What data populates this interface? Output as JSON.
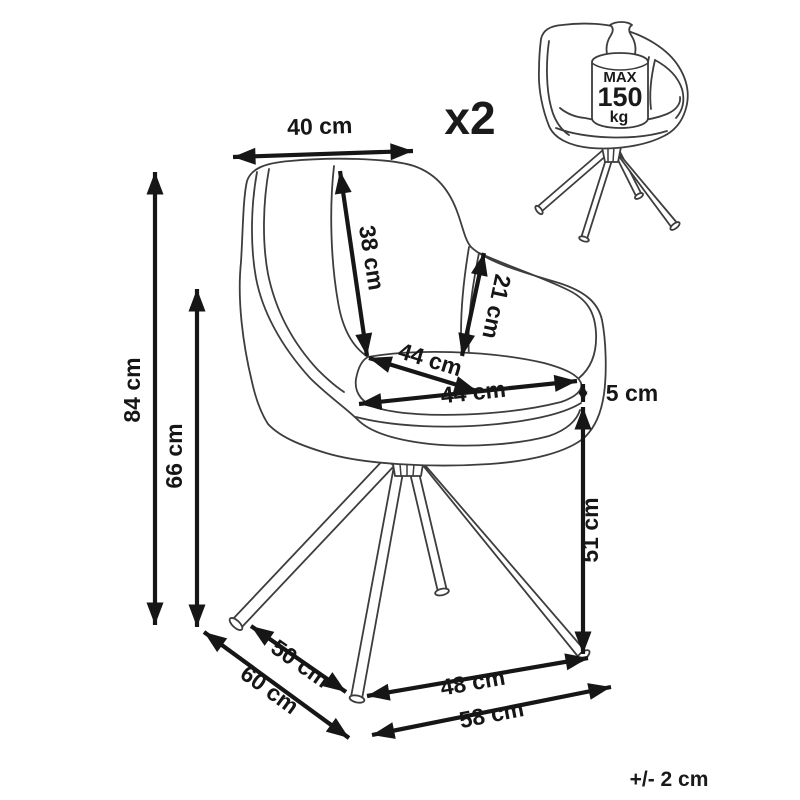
{
  "diagram": {
    "quantity": "x2",
    "weight_limit": {
      "line1": "MAX",
      "line2": "150",
      "line3": "kg"
    },
    "tolerance": "+/- 2 cm",
    "dimensions": {
      "top_width": "40 cm",
      "total_height": "84 cm",
      "armrest_floor_height": "66 cm",
      "backrest_height": "38 cm",
      "armrest_height": "21 cm",
      "seat_depth": "44 cm",
      "seat_width": "44 cm",
      "cushion_thickness": "5 cm",
      "seat_height": "51 cm",
      "base_side_depth": "50 cm",
      "base_outer_side_depth": "60 cm",
      "base_front_width": "48 cm",
      "base_outer_width": "58 cm"
    },
    "colors": {
      "line": "#3d3d3d",
      "dimension": "#161616",
      "background": "#ffffff"
    }
  }
}
